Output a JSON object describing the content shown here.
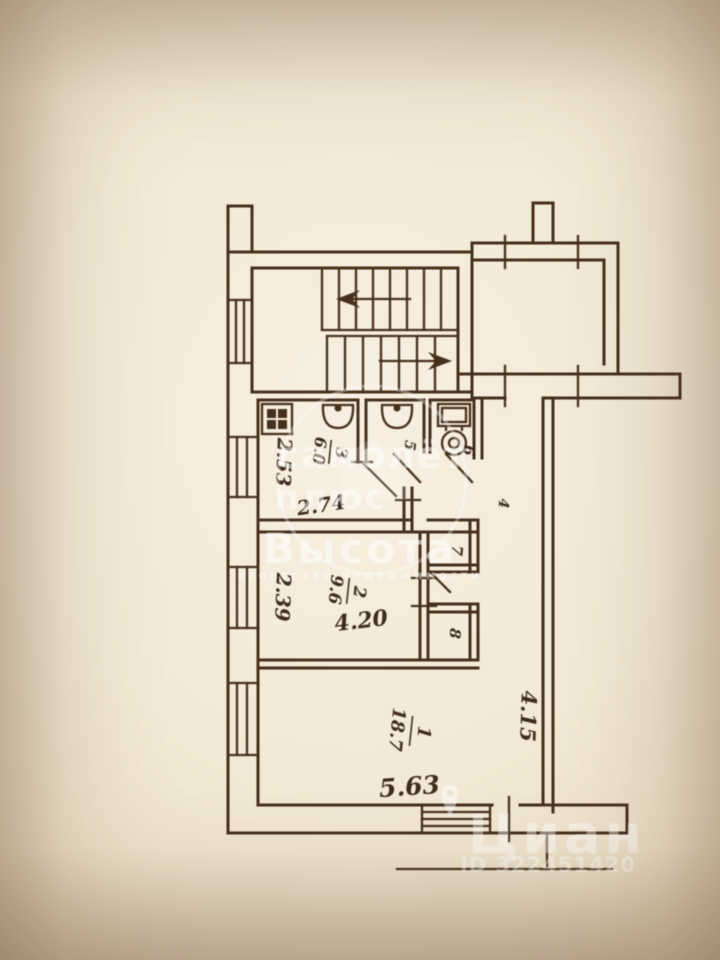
{
  "labels": {
    "room1_num": "1",
    "room1_area": "18.7",
    "room2_num": "2",
    "room2_area": "9.6",
    "room3_num": "3",
    "room3_area": "6.0",
    "room4_num": "4",
    "room5_num": "5",
    "room6_num": "6",
    "room7_num": "7",
    "room8_num": "8",
    "dim_kitchen_width": "2.53",
    "dim_kitchen_depth": "2.74",
    "dim_room2_width": "2.39",
    "dim_room2_depth": "4.20",
    "dim_room1_width": "4.15",
    "dim_room1_depth": "5.63"
  },
  "watermarks": {
    "samolet_word1": "самолёт",
    "samolet_word2": "плюс",
    "vysota_title": "Высота",
    "vysota_subtitle": "агентство недвижимости",
    "cian_title": "Циан",
    "cian_id": "ID 322451420"
  },
  "colors": {
    "ink": "#46301d",
    "paper": "#f2e8d5",
    "watermark": "#ffffff"
  }
}
